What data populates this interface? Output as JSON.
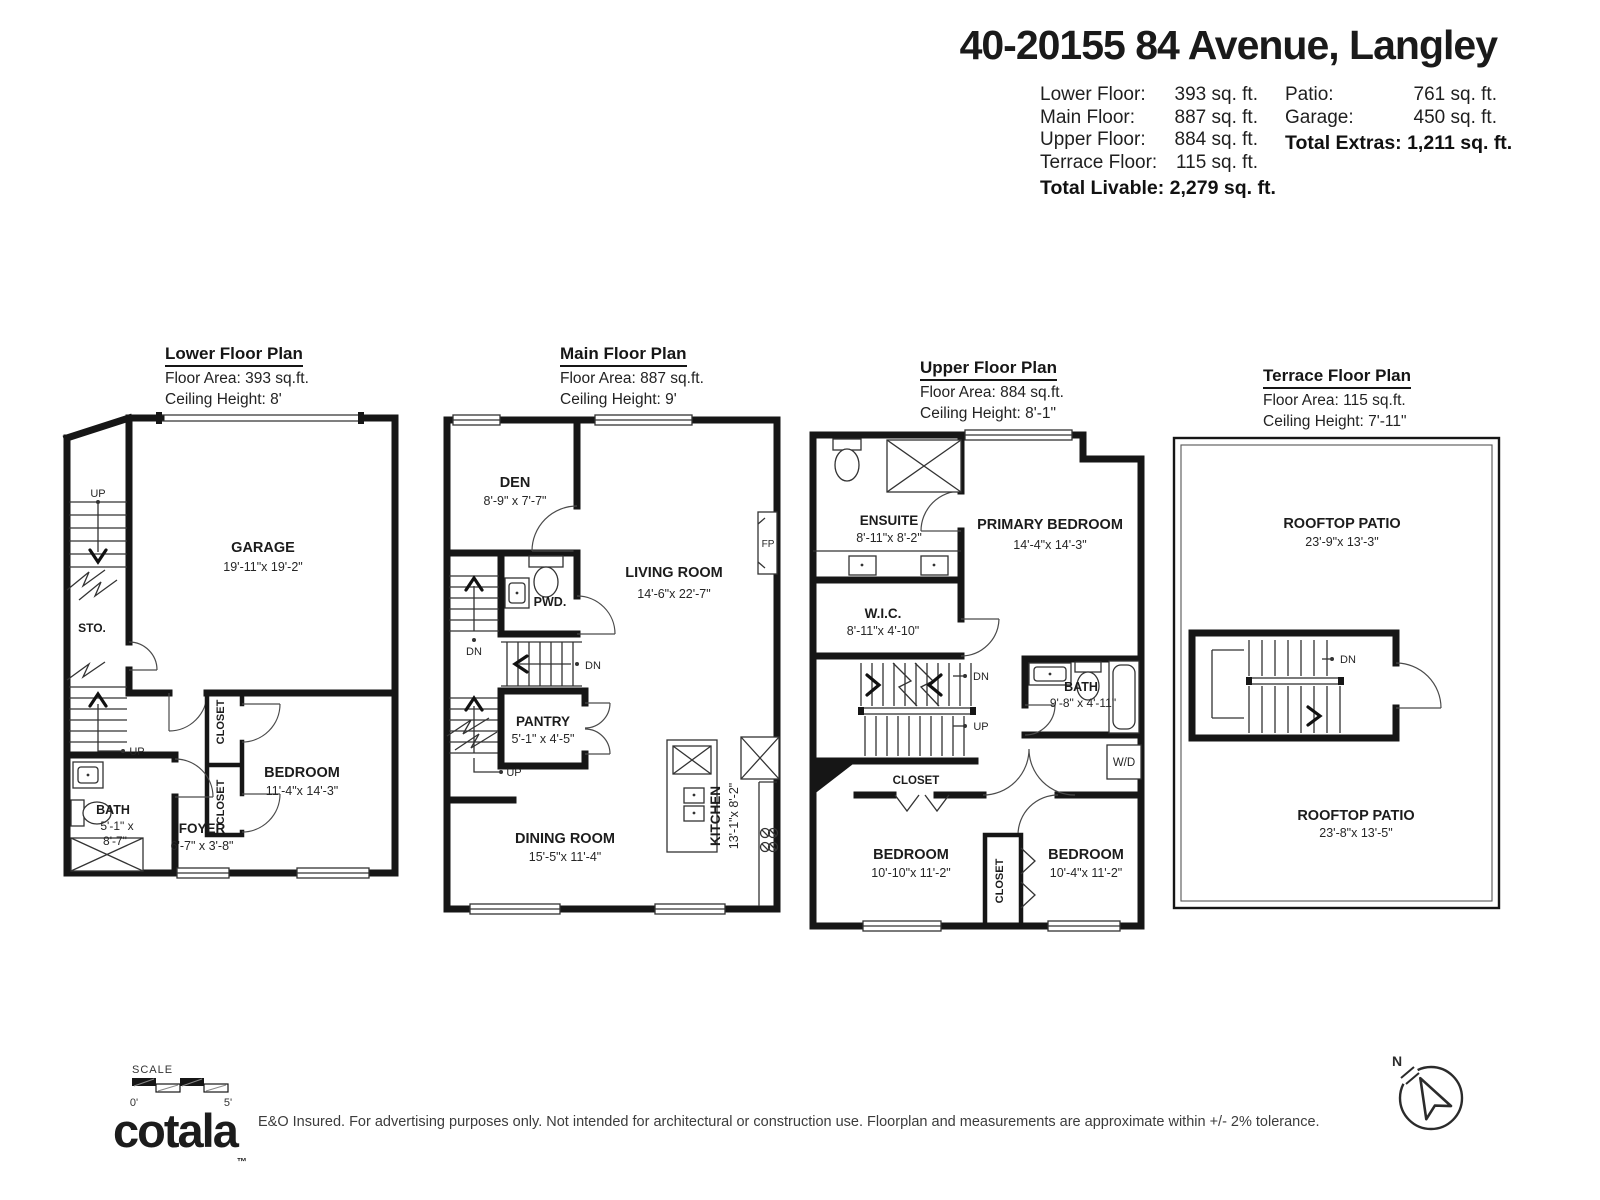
{
  "header": {
    "title": "40-20155 84 Avenue, Langley",
    "stats_left": [
      {
        "label": "Lower Floor:",
        "value": "393 sq. ft."
      },
      {
        "label": "Main Floor:",
        "value": "887 sq. ft."
      },
      {
        "label": "Upper Floor:",
        "value": "884 sq. ft."
      },
      {
        "label": "Terrace Floor:",
        "value": "115 sq. ft."
      }
    ],
    "total_livable": "Total Livable: 2,279 sq. ft.",
    "stats_right": [
      {
        "label": "Patio:",
        "value": "761 sq. ft."
      },
      {
        "label": "Garage:",
        "value": "450 sq. ft."
      }
    ],
    "total_extras": "Total Extras: 1,211 sq. ft."
  },
  "plans": [
    {
      "title": "Lower Floor Plan",
      "area": "Floor Area: 393 sq.ft.",
      "ceiling": "Ceiling Height: 8'",
      "labels": {
        "garage": "GARAGE",
        "garage_dims": "19'-11\"x 19'-2\"",
        "sto": "STO.",
        "up": "UP",
        "up2": "UP",
        "closet": "CLOSET",
        "closet2": "CLOSET",
        "bath": "BATH",
        "bath_dims1": "5'-1\" x",
        "bath_dims2": "8'-7\"",
        "foyer": "FOYER",
        "foyer_dims": "6'-7\" x 3'-8\"",
        "bedroom": "BEDROOM",
        "bedroom_dims": "11'-4\"x 14'-3\""
      }
    },
    {
      "title": "Main Floor Plan",
      "area": "Floor Area: 887 sq.ft.",
      "ceiling": "Ceiling Height: 9'",
      "labels": {
        "den": "DEN",
        "den_dims": "8'-9\" x 7'-7\"",
        "living": "LIVING ROOM",
        "living_dims": "14'-6\"x 22'-7\"",
        "pwd": "PWD.",
        "fp": "FP",
        "dn": "DN",
        "dn2": "DN",
        "up": "UP",
        "pantry": "PANTRY",
        "pantry_dims": "5'-1\" x 4'-5\"",
        "dining": "DINING ROOM",
        "dining_dims": "15'-5\"x 11'-4\"",
        "kitchen": "KITCHEN",
        "kitchen_dims": "13'-1\"x 8'-2\""
      }
    },
    {
      "title": "Upper Floor Plan",
      "area": "Floor Area: 884 sq.ft.",
      "ceiling": "Ceiling Height: 8'-1\"",
      "labels": {
        "ensuite": "ENSUITE",
        "ensuite_dims": "8'-11\"x 8'-2\"",
        "primary": "PRIMARY BEDROOM",
        "primary_dims": "14'-4\"x 14'-3\"",
        "wic": "W.I.C.",
        "wic_dims": "8'-11\"x 4'-10\"",
        "dn": "DN",
        "up": "UP",
        "closet": "CLOSET",
        "closet2": "CLOSET",
        "bath": "BATH",
        "bath_dims": "9'-8\" x 4'-11\"",
        "wd": "W/D",
        "bedroom1": "BEDROOM",
        "bedroom1_dims": "10'-10\"x 11'-2\"",
        "bedroom2": "BEDROOM",
        "bedroom2_dims": "10'-4\"x 11'-2\""
      }
    },
    {
      "title": "Terrace Floor Plan",
      "area": "Floor Area: 115 sq.ft.",
      "ceiling": "Ceiling Height: 7'-11\"",
      "labels": {
        "patio1": "ROOFTOP PATIO",
        "patio1_dims": "23'-9\"x 13'-3\"",
        "patio2": "ROOFTOP PATIO",
        "patio2_dims": "23'-8\"x 13'-5\"",
        "dn": "DN"
      }
    }
  ],
  "footer": {
    "scale_label": "SCALE",
    "scale_start": "0'",
    "scale_end": "5'",
    "logo": "cotala",
    "logo_tm": "™",
    "disclaimer": "E&O Insured. For advertising purposes only. Not intended for architectural or construction use. Floorplan and measurements are approximate within +/- 2% tolerance.",
    "compass_n": "N"
  }
}
